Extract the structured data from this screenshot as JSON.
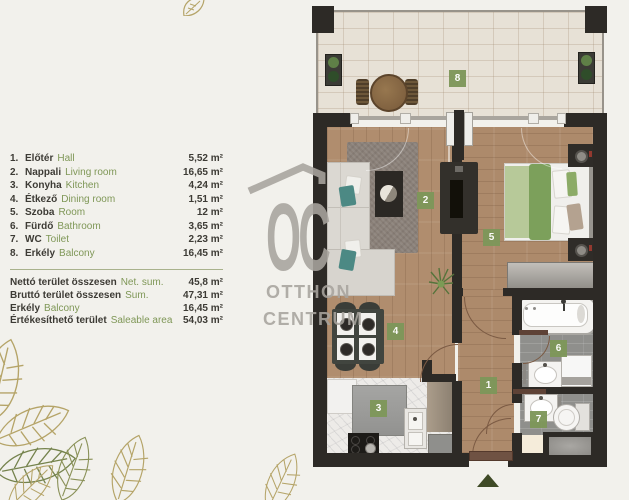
{
  "legend": {
    "items": [
      {
        "num": "1.",
        "hu": "Előtér",
        "en": "Hall",
        "area": "5,52 m²"
      },
      {
        "num": "2.",
        "hu": "Nappali",
        "en": "Living room",
        "area": "16,65 m²"
      },
      {
        "num": "3.",
        "hu": "Konyha",
        "en": "Kitchen",
        "area": "4,24 m²"
      },
      {
        "num": "4.",
        "hu": "Étkező",
        "en": "Dining room",
        "area": "1,51 m²"
      },
      {
        "num": "5.",
        "hu": "Szoba",
        "en": "Room",
        "area": "12 m²"
      },
      {
        "num": "6.",
        "hu": "Fürdő",
        "en": "Bathroom",
        "area": "3,65 m²"
      },
      {
        "num": "7.",
        "hu": "WC",
        "en": "Toilet",
        "area": "2,23 m²"
      },
      {
        "num": "8.",
        "hu": "Erkély",
        "en": "Balcony",
        "area": "16,45 m²"
      }
    ],
    "summary": [
      {
        "hu": "Nettó terület összesen",
        "en": "Net. sum.",
        "area": "45,8 m²"
      },
      {
        "hu": "Bruttó terület összesen",
        "en": "Sum.",
        "area": "47,31 m²"
      },
      {
        "hu": "Erkély",
        "en": "Balcony",
        "area": "16,45 m²"
      },
      {
        "hu": "Értékesíthető terület",
        "en": "Saleable area",
        "area": "54,03 m²"
      }
    ]
  },
  "watermark": {
    "monogram": "OC",
    "line1": "OTTHON",
    "line2": "CENTRUM"
  },
  "plan": {
    "markers": [
      "1",
      "2",
      "3",
      "4",
      "5",
      "6",
      "7",
      "8"
    ],
    "colors": {
      "background": "#f2f1ec",
      "wall": "#2d2a26",
      "marker_green": "#7e975a",
      "legend_green": "#7f9757",
      "legend_dark": "#3d3b35",
      "wood": "#b08d6e",
      "balcony_tile": "#e7e1d6",
      "bath_tile": "#8f8f8c",
      "bed_green": "#7ca05b",
      "leaf_gold": "#b5a468",
      "leaf_olive": "#75834d"
    }
  }
}
